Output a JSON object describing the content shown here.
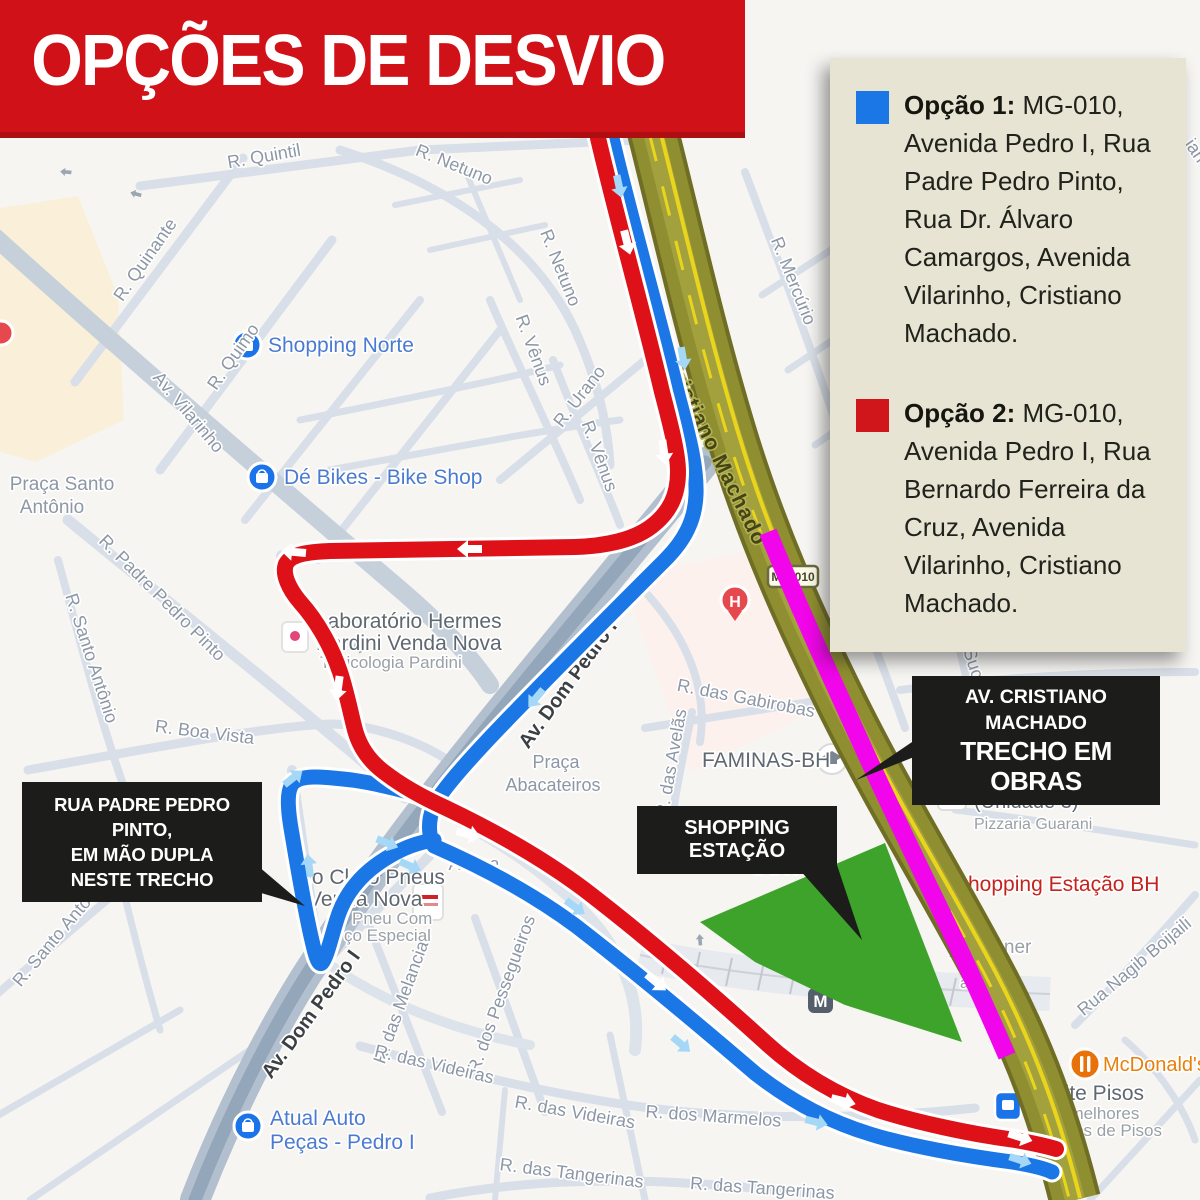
{
  "title": "OPÇÕES DE DESVIO",
  "legend": {
    "options": [
      {
        "label": "Opção 1:",
        "text": "MG-010, Avenida Pedro I, Rua Padre Pedro Pinto, Rua Dr. Álvaro Camargos, Avenida Vilarinho, Cristiano Machado.",
        "color": "#1c77e6"
      },
      {
        "label": "Opção 2:",
        "text": "MG-010, Avenida Pedro I, Rua Bernardo Ferreira da Cruz, Avenida Vilarinho, Cristiano Machado.",
        "color": "#d0151b"
      }
    ]
  },
  "callouts": {
    "padre_pedro": {
      "line1": "RUA PADRE PEDRO PINTO,",
      "line2": "EM MÃO DUPLA",
      "line3": "NESTE TRECHO"
    },
    "shopping_estacao": {
      "text": "SHOPPING ESTAÇÃO"
    },
    "obras": {
      "line1": "AV. CRISTIANO MACHADO",
      "line2": "TRECHO EM OBRAS"
    }
  },
  "map": {
    "highway_shield": "MG-010",
    "route_colors": {
      "option1_blue": "#1c77e6",
      "option2_red": "#de1118",
      "construction_magenta": "#f105ea",
      "highway_olive": "#8f8e31",
      "shopping_area_green": "#3ea32a",
      "arrow_on_blue": "#a5d8f6",
      "arrow_on_red": "#ffffff"
    },
    "street_labels": [
      {
        "t": "R. Quintil",
        "x": 265,
        "y": 162,
        "r": -10
      },
      {
        "t": "R. Netuno",
        "x": 452,
        "y": 170,
        "r": 22
      },
      {
        "t": "R. Quinante",
        "x": 150,
        "y": 263,
        "r": -55
      },
      {
        "t": "R. Quimo",
        "x": 238,
        "y": 360,
        "r": -55
      },
      {
        "t": "R. Netuno",
        "x": 555,
        "y": 270,
        "r": 68
      },
      {
        "t": "R. Vênus",
        "x": 528,
        "y": 352,
        "r": 70
      },
      {
        "t": "R. Urano",
        "x": 584,
        "y": 400,
        "r": -52
      },
      {
        "t": "R. Vênus",
        "x": 594,
        "y": 458,
        "r": 70
      },
      {
        "t": "Av. Vilarinho",
        "x": 184,
        "y": 416,
        "r": 50
      },
      {
        "t": "R. Padre Pedro Pinto",
        "x": 158,
        "y": 602,
        "r": 45
      },
      {
        "t": "R. Santo Antônio",
        "x": 86,
        "y": 660,
        "r": 72
      },
      {
        "t": "R. Boa Vista",
        "x": 204,
        "y": 738,
        "r": 7
      },
      {
        "t": "R. Mercúrio",
        "x": 788,
        "y": 283,
        "r": 68
      },
      {
        "t": "R. das Gabirobas",
        "x": 745,
        "y": 704,
        "r": 11
      },
      {
        "t": "R. das Avelãs",
        "x": 677,
        "y": 764,
        "r": -80
      },
      {
        "t": "R. Iúc",
        "x": 854,
        "y": 592,
        "r": 62
      },
      {
        "t": "Rua Suc",
        "x": 962,
        "y": 647,
        "r": 72
      },
      {
        "t": "R. Santo Antônio",
        "x": 64,
        "y": 936,
        "r": -50
      },
      {
        "t": "Av. Dom Pedro I",
        "x": 573,
        "y": 688,
        "r": -54,
        "c": "dark",
        "s": 20,
        "w": 600
      },
      {
        "t": "Av. Dom Pedro I",
        "x": 316,
        "y": 1018,
        "r": -54,
        "c": "dark",
        "s": 20,
        "w": 600
      },
      {
        "t": "R. das Melancias",
        "x": 408,
        "y": 1000,
        "r": -70
      },
      {
        "t": "R. dos Pessegueiros",
        "x": 507,
        "y": 996,
        "r": -70
      },
      {
        "t": "R. das Videiras",
        "x": 433,
        "y": 1070,
        "r": 13
      },
      {
        "t": "R. das Videiras",
        "x": 574,
        "y": 1118,
        "r": 10
      },
      {
        "t": "R. das Tangerinas",
        "x": 571,
        "y": 1179,
        "r": 7
      },
      {
        "t": "R. dos Marmelos",
        "x": 713,
        "y": 1122,
        "r": 4
      },
      {
        "t": "R. das Tangerinas",
        "x": 762,
        "y": 1194,
        "r": 4
      },
      {
        "t": "Rua Nagib Boijaili",
        "x": 1138,
        "y": 971,
        "r": -40
      },
      {
        "t": "Praça Santo",
        "x": 62,
        "y": 490,
        "r": 0,
        "s": 19
      },
      {
        "t": "Antônio",
        "x": 52,
        "y": 513,
        "r": 0,
        "s": 19
      },
      {
        "t": "Praça",
        "x": 556,
        "y": 768,
        "r": 0,
        "s": 18
      },
      {
        "t": "Abacateiros",
        "x": 553,
        "y": 791,
        "r": 0,
        "s": 18
      },
      {
        "t": "Abaca",
        "x": 474,
        "y": 870,
        "r": 0
      },
      {
        "t": "O Bot",
        "x": 774,
        "y": 874,
        "r": 0
      },
      {
        "t": "ian",
        "x": 1191,
        "y": 154,
        "r": 55
      },
      {
        "t": "Cristiano Machado",
        "x": 710,
        "y": 455,
        "r": 64,
        "c": "hw",
        "s": 21,
        "w": 600,
        "layer": "top"
      }
    ],
    "poi_labels": [
      {
        "t": "Shopping Norte",
        "x": 268,
        "y": 352,
        "c": "blue",
        "s": 21,
        "a": "s"
      },
      {
        "t": "Dé Bikes - Bike Shop",
        "x": 284,
        "y": 484,
        "c": "blue",
        "s": 21,
        "a": "s"
      },
      {
        "t": "Laboratório Hermes",
        "x": 316,
        "y": 628,
        "c": "poi",
        "s": 21,
        "a": "s"
      },
      {
        "t": "Pardini Venda Nova",
        "x": 316,
        "y": 650,
        "c": "poi",
        "s": 21,
        "a": "s"
      },
      {
        "t": "Toxicologia Pardini",
        "x": 320,
        "y": 668,
        "c": "poi2",
        "s": 17,
        "a": "s"
      },
      {
        "t": "FAMINAS-BH",
        "x": 702,
        "y": 767,
        "c": "poi",
        "s": 21,
        "a": "s"
      },
      {
        "t": "Pizzaria Guarani",
        "x": 974,
        "y": 786,
        "c": "poi",
        "s": 20,
        "a": "s"
      },
      {
        "t": "(Unidade 3)",
        "x": 974,
        "y": 808,
        "c": "poi",
        "s": 20,
        "a": "s"
      },
      {
        "t": "Pizzaria Guarani",
        "x": 974,
        "y": 829,
        "c": "poi2",
        "s": 16,
        "a": "s"
      },
      {
        "t": "Shopping Estação BH",
        "x": 954,
        "y": 891,
        "c": "red",
        "s": 21,
        "a": "s"
      },
      {
        "t": "ja Penner",
        "x": 950,
        "y": 953,
        "c": "poi2",
        "s": 19,
        "a": "s"
      },
      {
        "t": "Dia",
        "x": 966,
        "y": 971,
        "c": "poi2",
        "s": 16,
        "a": "s"
      },
      {
        "t": "as",
        "x": 960,
        "y": 988,
        "c": "poi2",
        "s": 16,
        "a": "s"
      },
      {
        "t": "Vilarinho",
        "x": 841,
        "y": 1005,
        "c": "dark",
        "s": 22,
        "a": "s",
        "w": 600
      },
      {
        "t": "McDonald's",
        "x": 1103,
        "y": 1071,
        "c": "orange",
        "s": 20,
        "a": "s"
      },
      {
        "t": "Elite Pisos",
        "x": 1046,
        "y": 1100,
        "c": "poi",
        "s": 21,
        "a": "s"
      },
      {
        "t": "Os melhores",
        "x": 1043,
        "y": 1119,
        "c": "poi2",
        "s": 17,
        "a": "s"
      },
      {
        "t": "preços de Pisos",
        "x": 1041,
        "y": 1136,
        "c": "poi2",
        "s": 17,
        "a": "s"
      },
      {
        "t": "Atual Auto",
        "x": 270,
        "y": 1125,
        "c": "blue",
        "s": 21,
        "a": "s"
      },
      {
        "t": "Peças - Pedro I",
        "x": 270,
        "y": 1149,
        "c": "blue",
        "s": 21,
        "a": "s"
      },
      {
        "t": "Rio Claro Pneus",
        "x": 292,
        "y": 884,
        "c": "poi",
        "s": 21,
        "a": "s"
      },
      {
        "t": "Venda Nova",
        "x": 308,
        "y": 906,
        "c": "poi",
        "s": 21,
        "a": "s"
      },
      {
        "t": "Pneu Com",
        "x": 352,
        "y": 924,
        "c": "poi2",
        "s": 17,
        "a": "s"
      },
      {
        "t": "ço Especial",
        "x": 344,
        "y": 941,
        "c": "poi2",
        "s": 17,
        "a": "s"
      }
    ]
  }
}
